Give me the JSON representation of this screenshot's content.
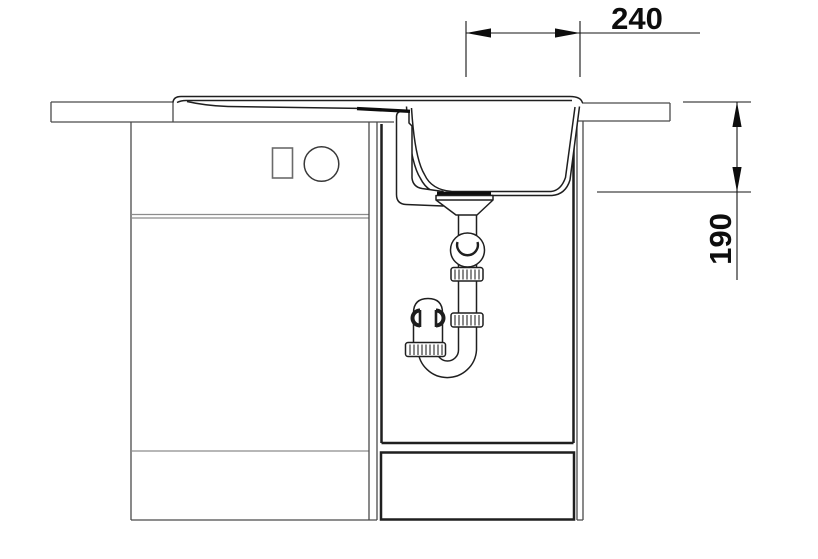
{
  "drawing": {
    "type": "kitchen-sink-installation-section",
    "background": "#ffffff",
    "colors": {
      "furniture_line": "#4a4a4a",
      "light_divider_line": "#8c8c8c",
      "panel_line": "#1f1f1f",
      "sink_line": "#1f1f1f",
      "dimension_line": "#151515",
      "text": "#0d0d0d"
    },
    "dimensions": {
      "outlet_offset": {
        "value": "240",
        "orientation": "horizontal"
      },
      "bowl_depth": {
        "value": "190",
        "orientation": "vertical"
      }
    },
    "components": [
      "countertop",
      "drainboard-sink-rim",
      "sink-bowl",
      "left-base-cabinet",
      "sink-base-cabinet",
      "cabinet-door-panel",
      "plinth-panel",
      "siphon-trap",
      "drain-ball-joint",
      "u-bend"
    ]
  }
}
